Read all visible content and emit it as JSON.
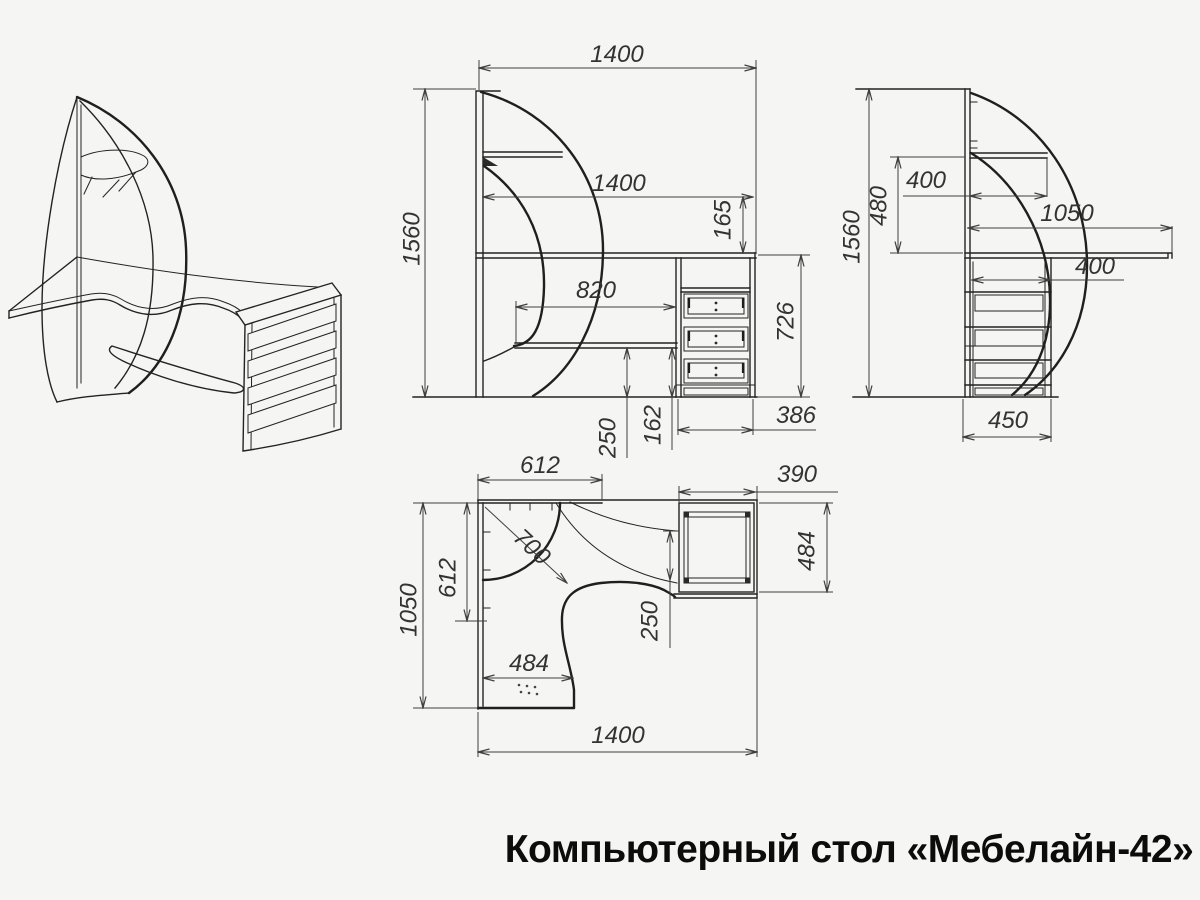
{
  "title": "Компьютерный стол «Мебелайн-42»",
  "colors": {
    "background": "#f5f5f3",
    "line": "#232323",
    "dimension_line": "#3f3f3f",
    "dimension_text": "#333333",
    "title_text": "#0c0c0c"
  },
  "views": {
    "isometric": {
      "description": "isometric-sketch-of-corner-desk"
    },
    "front": {
      "dims": {
        "overall_width": "1400",
        "desktop_width": "1400",
        "back_rail_height": "165",
        "overall_height": "1560",
        "keyboard_shelf_width": "820",
        "desktop_height": "726",
        "shelf_to_floor": "250",
        "plinth_height": "162",
        "pedestal_width": "386"
      }
    },
    "side": {
      "dims": {
        "overall_height": "1560",
        "shelf_above_desktop": "480",
        "corner_shelf_depth": "400",
        "desktop_depth": "1050",
        "keyboard_shelf_depth": "400",
        "pedestal_depth": "450"
      }
    },
    "plan": {
      "dims": {
        "back_edge_section": "612",
        "pedestal_width": "390",
        "left_edge_section": "612",
        "overall_depth": "1050",
        "corner_leader": "700",
        "pedestal_depth": "484",
        "edge_offset": "250",
        "front_section_width": "484",
        "overall_width": "1400"
      }
    }
  }
}
